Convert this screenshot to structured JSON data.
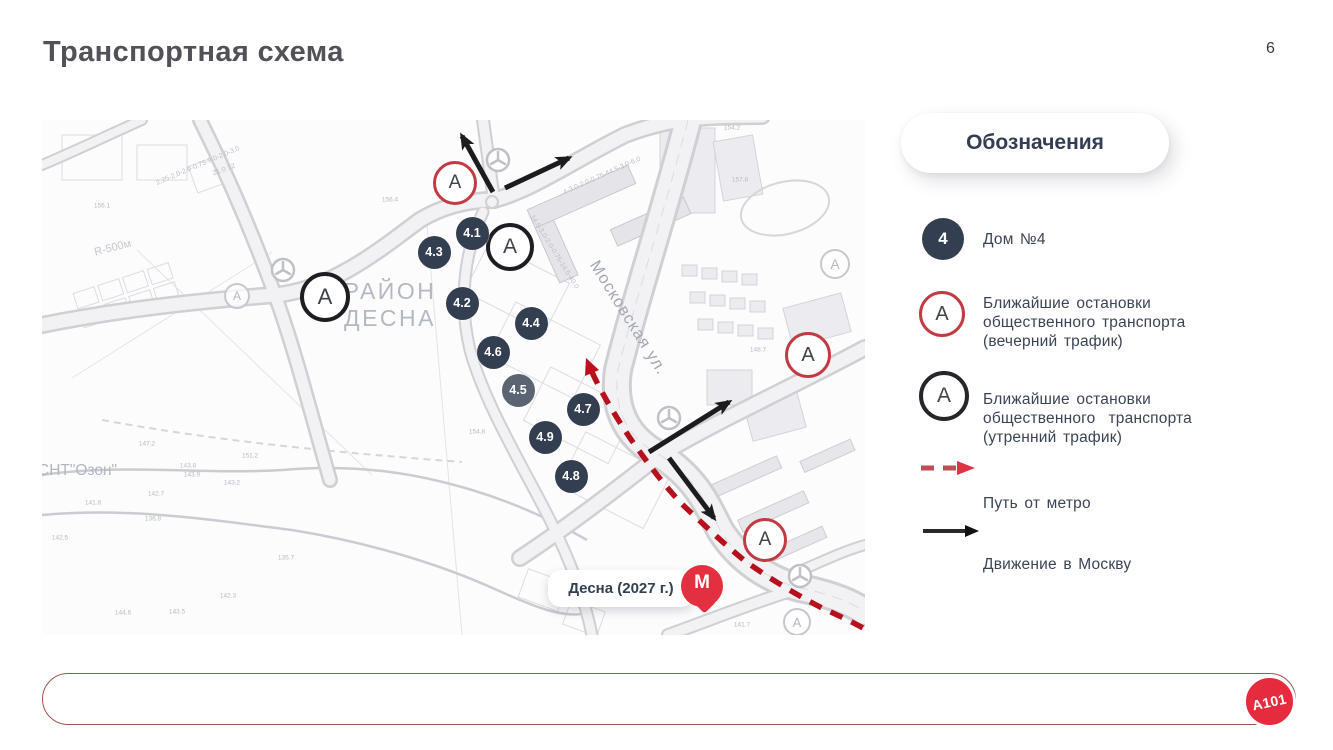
{
  "page": {
    "title": "Транспортная схема",
    "number": "6"
  },
  "map": {
    "district_line1": "РАЙОН",
    "district_line2": "ДЕСНА",
    "street": "Московская ул.",
    "snt": "СНТ\"Озон\"",
    "radius_note": "R-500м",
    "stop_letter": "А",
    "metro": {
      "label": "Десна (2027 г.)",
      "letter": "М"
    },
    "buildings": [
      {
        "id": "4.1",
        "x": 430,
        "y": 113
      },
      {
        "id": "4.3",
        "x": 392,
        "y": 132
      },
      {
        "id": "4.2",
        "x": 420,
        "y": 183
      },
      {
        "id": "4.4",
        "x": 489,
        "y": 203
      },
      {
        "id": "4.6",
        "x": 451,
        "y": 232
      },
      {
        "id": "4.5",
        "x": 476,
        "y": 270,
        "dim": true
      },
      {
        "id": "4.7",
        "x": 541,
        "y": 289
      },
      {
        "id": "4.9",
        "x": 503,
        "y": 317
      },
      {
        "id": "4.8",
        "x": 529,
        "y": 356
      }
    ],
    "stops_evening": [
      {
        "x": 413,
        "y": 63,
        "r": 22
      },
      {
        "x": 766,
        "y": 235,
        "r": 23
      },
      {
        "x": 723,
        "y": 420,
        "r": 22
      }
    ],
    "stops_morning": [
      {
        "x": 468,
        "y": 127,
        "r": 24
      },
      {
        "x": 283,
        "y": 177,
        "r": 25
      }
    ],
    "stops_faint": [
      {
        "x": 791,
        "y": 142,
        "r": 13
      },
      {
        "x": 193,
        "y": 174,
        "r": 11
      },
      {
        "x": 753,
        "y": 500,
        "r": 12
      }
    ],
    "roundabouts": [
      {
        "x": 456,
        "y": 40
      },
      {
        "x": 241,
        "y": 150
      },
      {
        "x": 627,
        "y": 298
      },
      {
        "x": 758,
        "y": 456
      }
    ],
    "elevations": [
      {
        "t": "147.2",
        "x": 105,
        "y": 324
      },
      {
        "t": "151.2",
        "x": 208,
        "y": 336
      },
      {
        "t": "143.9",
        "x": 150,
        "y": 355
      },
      {
        "t": "143.2",
        "x": 190,
        "y": 363
      },
      {
        "t": "142.7",
        "x": 114,
        "y": 374
      },
      {
        "t": "141.8",
        "x": 51,
        "y": 383
      },
      {
        "t": "136.8",
        "x": 111,
        "y": 399
      },
      {
        "t": "142.5",
        "x": 18,
        "y": 418
      },
      {
        "t": "135.7",
        "x": 244,
        "y": 438
      },
      {
        "t": "142.3",
        "x": 186,
        "y": 476
      },
      {
        "t": "144.6",
        "x": 81,
        "y": 493
      },
      {
        "t": "143.5",
        "x": 135,
        "y": 492
      },
      {
        "t": "157.8",
        "x": 698,
        "y": 60
      },
      {
        "t": "148.7",
        "x": 716,
        "y": 230
      },
      {
        "t": "154.8",
        "x": 435,
        "y": 312
      },
      {
        "t": "143.8",
        "x": 146,
        "y": 346
      },
      {
        "t": "156.4",
        "x": 348,
        "y": 80
      },
      {
        "t": "156.1",
        "x": 60,
        "y": 86
      },
      {
        "t": "154.2",
        "x": 690,
        "y": 8
      },
      {
        "t": "141.7",
        "x": 700,
        "y": 505
      }
    ],
    "road_specs": [
      {
        "t": "2.25-2.0-2.0-0.75-9.0-2.0-3.0",
        "x": 156,
        "y": 46,
        "rot": -23
      },
      {
        "t": "14.5-3.0-2.0-0.75-14.5-40.0",
        "x": 512,
        "y": 132,
        "rot": 58
      },
      {
        "t": "4-3.0-2.0-0.75-44.5-3.0-6.0",
        "x": 560,
        "y": 56,
        "rot": -24
      },
      {
        "t": "21.0  12",
        "x": 182,
        "y": 50,
        "rot": -20
      }
    ]
  },
  "legend": {
    "header": "Обозначения",
    "house": {
      "symbol": "4",
      "label": "Дом №4"
    },
    "evening": {
      "symbol": "А",
      "lines": [
        "Ближайшие остановки",
        "общественного транспорта",
        "(вечерний трафик)"
      ]
    },
    "morning": {
      "symbol": "А",
      "lines": [
        "Ближайшие остановки",
        "общественного  транспорта",
        "(утренний трафик)"
      ]
    },
    "metro_path_label": "Путь от метро",
    "moscow_label": "Движение в Москву"
  },
  "footer": {
    "logo": "A101"
  },
  "colors": {
    "navy": "#333F50",
    "stop_red": "#C23B44",
    "dash_red": "#B5101C",
    "brand_red": "#E52B3D",
    "map_gray": "#d2d2d7"
  }
}
